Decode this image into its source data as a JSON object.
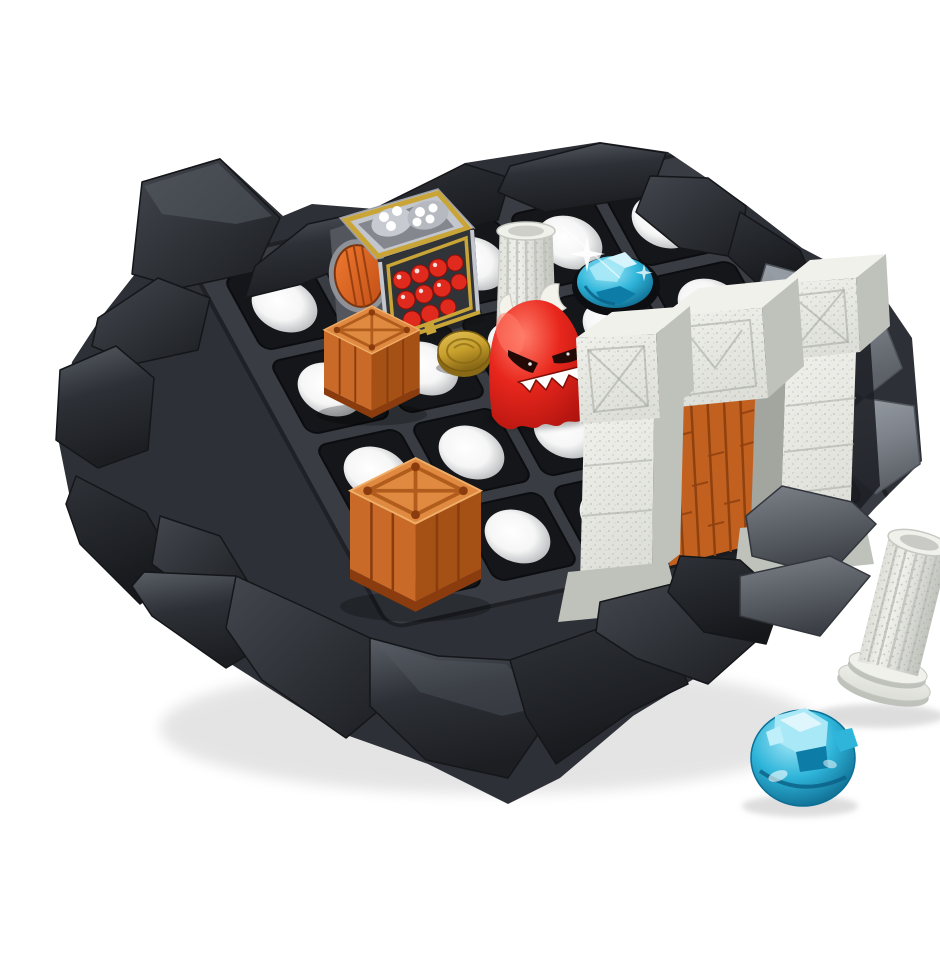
{
  "scene": {
    "type": "product-photo",
    "description": "Board game product photo: a dark grey rocky dungeon base holding a 5x4 peg grid. On it sit a silver dice-roller treasure chest with gold trim and red gems inside, two orange wooden crates with X straps, a gold coin, a red ghost monster with white horns and jagged teeth, a standing white fluted column, a blue gem in a grid slot, and a white stone gate with a wooden door. Beside the base on the white ground lie a fallen white column and a translucent blue gem.",
    "background": "#ffffff"
  },
  "board": {
    "grid": {
      "cols": 5,
      "rows": 4,
      "cell": 90,
      "inset": 6,
      "corner": 10,
      "hole_radius": 28
    }
  },
  "objects": [
    {
      "name": "rock-base",
      "desc": "faceted dark charcoal rock platform"
    },
    {
      "name": "peg-grid",
      "desc": "dark grey 5x4 grid of square slots with round holes"
    },
    {
      "name": "dice-chest",
      "desc": "silver cube dice roller, gold frame, white dice pips, red gems behind window, round orange door"
    },
    {
      "name": "crate-back",
      "desc": "orange crate with X strap lid"
    },
    {
      "name": "crate-front",
      "desc": "orange crate with X strap lid"
    },
    {
      "name": "gold-coin",
      "desc": "gold coin token"
    },
    {
      "name": "red-monster",
      "desc": "red ghost monster, white horns, angry eyes, white zigzag teeth"
    },
    {
      "name": "standing-column",
      "desc": "white speckled fluted column on the grid"
    },
    {
      "name": "board-gem",
      "desc": "blue gem sitting in a grid slot with a sparkle"
    },
    {
      "name": "stone-gate",
      "desc": "white speckled stone pillars and lintel with orange wooden plank door"
    },
    {
      "name": "fallen-column",
      "desc": "white fluted column lying beside the base"
    },
    {
      "name": "loose-gem",
      "desc": "translucent blue crystal gem on the ground"
    }
  ],
  "palette": {
    "bg": "#ffffff",
    "rock-dark": "#1c1e22",
    "rock-mid": "#2d3036",
    "rock-light": "#43474e",
    "rock-lighter": "#5a5f67",
    "rock-edge": "#141619",
    "gray-rock": "#7d828a",
    "gray-rock-light": "#9aa0a7",
    "gray-rock-dark": "#5d6269",
    "plate": "#393c42",
    "plate-edge": "#1f2126",
    "cell": "#141619",
    "hole-light": "#f6f6f6",
    "hole-mid": "#c9cbcd",
    "stone-light": "#f1f1ec",
    "stone": "#dddfd8",
    "stone-dark": "#bfc1bb",
    "stone-deep": "#a3a59f",
    "speck": "#94968f",
    "wood": "#c2611f",
    "wood-dark": "#8f4110",
    "wood-light": "#dd8640",
    "crate-top": "#e08a41",
    "crate-front": "#c96a28",
    "crate-side": "#a55015",
    "crate-dark": "#8a3c0e",
    "crate-line": "#b05c1d",
    "monster": "#e8271d",
    "monster-dark": "#a30f0b",
    "monster-light": "#ff7d69",
    "horn": "#f3f3ec",
    "eye": "#240a06",
    "coin": "#c8a02c",
    "coin-light": "#e3c35a",
    "coin-dark": "#8a6a16",
    "gem": "#2fb5da",
    "gem-dark": "#0d7da8",
    "gem-light": "#a9e9f7",
    "gem-deep": "#0a5f84",
    "metal": "#c3c6cc",
    "metal-mid": "#8e9298",
    "metal-dark": "#53565c",
    "gold": "#c9a437",
    "gold-dark": "#9a7c22",
    "shadow": "#c3c3c3"
  }
}
